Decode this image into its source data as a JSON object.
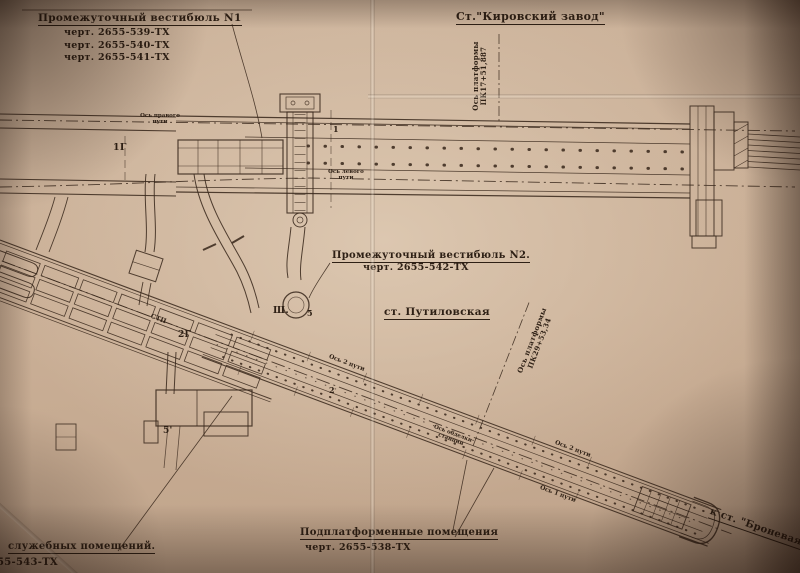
{
  "colors": {
    "paper": "#c9ae95",
    "ink": "#2e2015"
  },
  "annotations": {
    "vestibule_n1": {
      "title": "Промежуточный вестибюль N1",
      "drawings": [
        "черт. 2655-539-ТХ",
        "черт. 2655-540-ТХ",
        "черт. 2655-541-ТХ"
      ]
    },
    "station_kirovsky": {
      "title": "Ст.\"Кировский завод\""
    },
    "kirovsky_platform_axis": {
      "line1": "Ось платформы",
      "line2": "ПК17+51,887"
    },
    "vestibule_n2": {
      "title": "Промежуточный вестибюль N2.",
      "drawing": "черт. 2655-542-ТХ"
    },
    "station_putilovskaya": {
      "title": "ст. Путиловская"
    },
    "putilovskaya_platform_axis": {
      "line1": "Ось платформы",
      "line2": "ПК29+53,34"
    },
    "underplatform_rooms": {
      "title": "Подплатформенные помещения",
      "drawing": "черт. 2655-538-ТХ"
    },
    "service_rooms": {
      "title": "служебных помещений.",
      "drawing": "55-543-ТХ"
    },
    "to_bronevaya": {
      "title": "к ст. \"Броневая\""
    },
    "axes": {
      "right_track_l1": "Ось правого",
      "right_track_l2": "пути",
      "left_track_l1": "Ось левого",
      "left_track_l2": "пути",
      "track2_a": "Ось 2 пути",
      "track2_b": "Ось 2 пути",
      "track1": "Ось 1 пути",
      "station_lining_l1": "Ось обделки",
      "station_lining_l2": "станции",
      "stp": "СТП"
    },
    "marks": {
      "m_1g": "1Г",
      "m_2g": "2Г",
      "m_sh": "Ш.",
      "m_5": "5",
      "m_5p": "5'",
      "m_1": "1",
      "m_2": "2"
    }
  }
}
